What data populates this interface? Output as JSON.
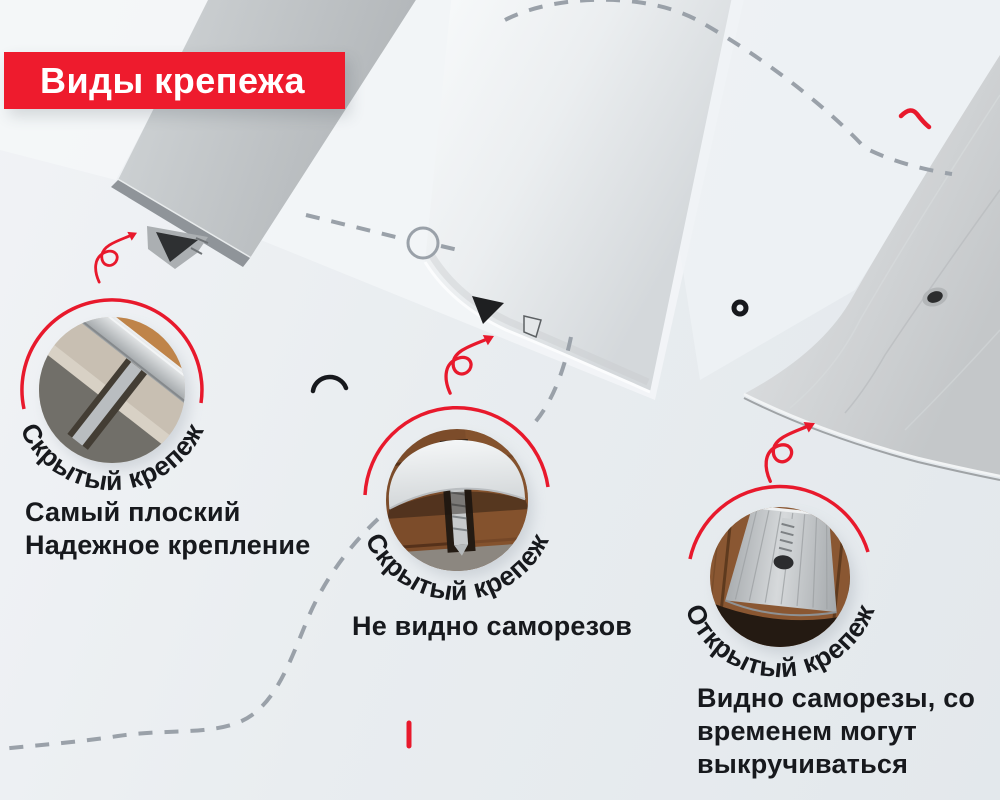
{
  "banner": {
    "title": "Виды крепежа"
  },
  "sections": [
    {
      "curved_label": "Скрытый крепеж",
      "description_lines": [
        "Самый плоский",
        "Надежное крепление"
      ]
    },
    {
      "curved_label": "Скрытый крепеж",
      "description_lines": [
        "Не видно саморезов"
      ]
    },
    {
      "curved_label": "Открытый крепеж",
      "description_lines": [
        "Видно саморезы, со",
        "временем могут",
        "выкручиваться"
      ]
    }
  ],
  "colors": {
    "background": "#eaedf0",
    "banner_red": "#ee1b2d",
    "accent_red": "#e8192c",
    "dash_gray": "#9aa1a9",
    "text_dark": "#17191d"
  },
  "icons": {
    "spiral_arrow": "curled red arrow pointing at profile tip",
    "ring_outline": "gray circle node on dashed path",
    "donut_dot": "small black ring",
    "arc_mark": "black open arc",
    "zigzag_mark": "small red zigzag",
    "tick_mark": "small red vertical tick"
  }
}
